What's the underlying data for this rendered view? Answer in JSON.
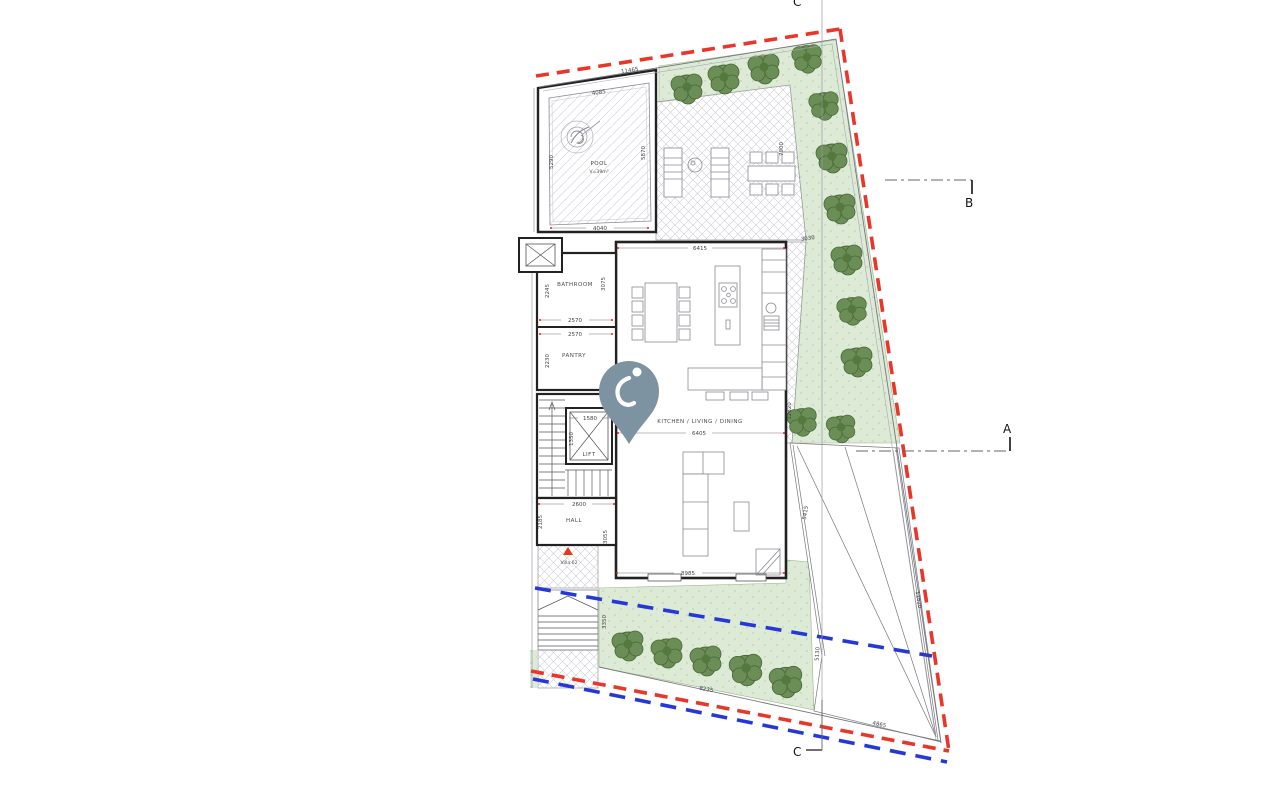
{
  "plan": {
    "markers": {
      "a": "A",
      "b": "B",
      "c": "C"
    },
    "rooms": {
      "pool": "POOL",
      "pool_vol": "V=39m³",
      "bathroom": "BATHROOM",
      "pantry": "PANTRY",
      "lift": "LIFT",
      "hall": "HALL",
      "living": "KITCHEN / LIVING / DINING",
      "unit": "Villa 02"
    },
    "dims": {
      "site_top": "11465",
      "pool_top": "4085",
      "pool_left": "5290",
      "pool_right": "5870",
      "pool_bottom": "4040",
      "living_top": "6415",
      "terrace_right": "7900",
      "terrace_bottom": "3030",
      "bathroom_left": "2245",
      "bathroom_bottom": "2570",
      "bathroom_right": "3075",
      "pantry_top": "2570",
      "pantry_left": "2230",
      "core_right": "9865",
      "lift_top": "1580",
      "lift_left": "1350",
      "hall_top": "2600",
      "hall_left": "2185",
      "hall_right": "3055",
      "living_mid": "6405",
      "living_bottom": "8985",
      "living_right": "12820",
      "garden_left": "3350",
      "garden_bottom": "8235",
      "garden_right": "5130",
      "drive_left": "5415",
      "drive_bottom": "4865",
      "site_right": "11620"
    },
    "colors": {
      "boundary": "#e8362a",
      "setback": "#2637d8",
      "landscape": "#dcead6",
      "pin": "#7e93a2"
    }
  }
}
